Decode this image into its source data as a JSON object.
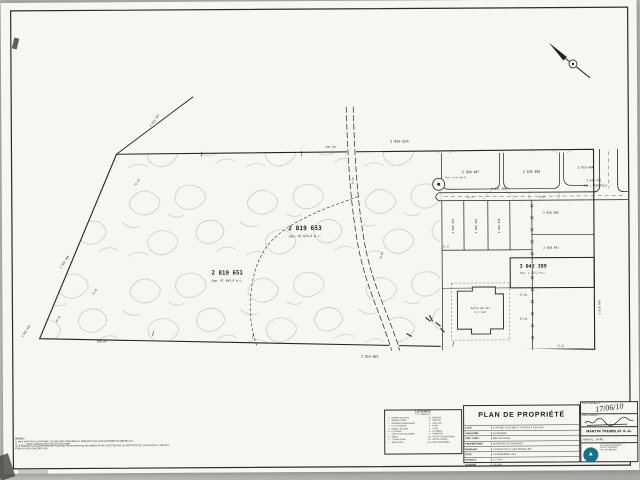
{
  "plan": {
    "labels": [
      {
        "t": "2 819 653",
        "x": 303,
        "y": 229,
        "s": 6.2,
        "b": 1
      },
      {
        "t": "Sup: 45 874,6 m.c.",
        "x": 303,
        "y": 236,
        "s": 3.0
      },
      {
        "t": "2 819 651",
        "x": 225,
        "y": 273,
        "s": 5.8,
        "b": 1
      },
      {
        "t": "Sup: 97 403,9 m.c.",
        "x": 225,
        "y": 280,
        "s": 2.9
      },
      {
        "t": "3 042 389",
        "x": 531,
        "y": 268,
        "s": 5.0,
        "b": 1
      },
      {
        "t": "Sup: 1 277,2 m.c.",
        "x": 531,
        "y": 274,
        "s": 2.6
      },
      {
        "t": "2 819 654",
        "x": 398,
        "y": 142,
        "s": 3.4
      },
      {
        "t": "237,34",
        "x": 329,
        "y": 147,
        "s": 2.8
      },
      {
        "t": "2 820 407",
        "x": 469,
        "y": 173,
        "s": 3.2
      },
      {
        "t": "2 820 408",
        "x": 530,
        "y": 173,
        "s": 3.2
      },
      {
        "t": "2 819 604",
        "x": 584,
        "y": 169,
        "s": 2.9
      },
      {
        "t": "3 040 762",
        "x": 592,
        "y": 182,
        "s": 2.7
      },
      {
        "t": "RUE L'HIRONDELLE",
        "x": 594,
        "y": 187,
        "s": 2.4
      },
      {
        "t": "3 042 386",
        "x": 497,
        "y": 190,
        "s": 2.9
      },
      {
        "t": "2 820 463",
        "x": 452,
        "y": 226,
        "s": 2.7,
        "r": -90
      },
      {
        "t": "2 820 462",
        "x": 475,
        "y": 226,
        "s": 2.7,
        "r": -90
      },
      {
        "t": "2 820 460",
        "x": 498,
        "y": 226,
        "s": 2.7,
        "r": -90
      },
      {
        "t": "2 820 485",
        "x": 549,
        "y": 214,
        "s": 2.9
      },
      {
        "t": "2 820 461",
        "x": 549,
        "y": 249,
        "s": 2.9
      },
      {
        "t": "57,91",
        "x": 521,
        "y": 296,
        "s": 2.5
      },
      {
        "t": "57,91",
        "x": 521,
        "y": 320,
        "s": 2.5
      },
      {
        "t": "2 819 602",
        "x": 367,
        "y": 357,
        "s": 3.2
      },
      {
        "t": "100,86",
        "x": 99,
        "y": 340,
        "s": 2.7
      },
      {
        "t": "2 819 497",
        "x": 154,
        "y": 119,
        "s": 2.7,
        "r": -54
      },
      {
        "t": "72,43",
        "x": 136,
        "y": 181,
        "s": 2.5,
        "r": -54
      },
      {
        "t": "2 819 598",
        "x": 63,
        "y": 260,
        "s": 2.7,
        "r": -56
      },
      {
        "t": "74,16",
        "x": 93,
        "y": 290,
        "s": 2.4,
        "r": -56
      },
      {
        "t": "29,42",
        "x": 56,
        "y": 317,
        "s": 2.4,
        "r": -56
      },
      {
        "t": "2 819 596",
        "x": 24,
        "y": 329,
        "s": 2.6,
        "r": -56
      },
      {
        "t": "2 819 607",
        "x": 598,
        "y": 308,
        "s": 2.7,
        "r": -90
      },
      {
        "t": "Salle de tir",
        "x": 478,
        "y": 309,
        "s": 2.7
      },
      {
        "t": "à l'arc",
        "x": 478,
        "y": 313,
        "s": 2.7
      },
      {
        "t": "Pos. d'un puits",
        "x": 444,
        "y": 178,
        "s": 2.3,
        "a": "s"
      },
      {
        "t": "15,24",
        "x": 468,
        "y": 198,
        "s": 2.1
      },
      {
        "t": "30,48",
        "x": 540,
        "y": 198,
        "s": 2.1
      },
      {
        "t": "37,21",
        "x": 558,
        "y": 347,
        "s": 2.3
      },
      {
        "t": "31,35",
        "x": 444,
        "y": 247,
        "s": 2.1
      },
      {
        "t": "35,05",
        "x": 380,
        "y": 255,
        "s": 2.3,
        "r": -80
      },
      {
        "t": "19,20",
        "x": 352,
        "y": 180,
        "s": 2.3,
        "r": -85
      }
    ]
  },
  "legend": {
    "title": "LÉGENDE",
    "subtitle": "( ET SYMBOLES )",
    "left": [
      {
        "sym": "●",
        "label": "BORNE TROUVÉE"
      },
      {
        "sym": "○",
        "label": "BORNE POSÉE"
      },
      {
        "sym": "▪",
        "label": "REPÈRE D'ARPENTAGE"
      },
      {
        "sym": "□",
        "label": "CLOU TROUVÉ"
      },
      {
        "sym": "△",
        "label": "PIQUET DE BOIS"
      },
      {
        "sym": "—×—",
        "label": "CLÔTURE"
      },
      {
        "sym": "– – –",
        "label": "LIMITE NON JALONNÉE"
      },
      {
        "sym": "⊙",
        "label": "PUITS"
      },
      {
        "sym": "≈",
        "label": "COURS D'EAU"
      },
      {
        "sym": "╌╌",
        "label": "SERVITUDE"
      }
    ],
    "right": [
      {
        "sym": "M",
        "label": "MESURE"
      },
      {
        "sym": "R",
        "label": "RÉNOVÉ"
      },
      {
        "sym": "C",
        "label": "CALCULÉ"
      },
      {
        "sym": "P",
        "label": "PLAN"
      },
      {
        "sym": "T",
        "label": "TITRE"
      },
      {
        "sym": "A",
        "label": "ATTRIBUÉ"
      },
      {
        "sym": "⌀",
        "label": "DIAMÈTRE"
      },
      {
        "sym": "S.I.",
        "label": "SYST. INTERNATIONAL"
      },
      {
        "sym": "m.c.",
        "label": "MÈTRE CARRÉ"
      },
      {
        "sym": "N.D.",
        "label": "NON DISPONIBLE"
      }
    ]
  },
  "titleblock": {
    "title": "PLAN DE PROPRIÉTÉ",
    "rows": [
      {
        "label": "LOTS",
        "value": "3 042 386, 3 042 389 ET 2 819 651 À 2 819 653"
      },
      {
        "label": "CADASTRE",
        "value": "DU QUÉBEC"
      },
      {
        "label": "CIRC. FONC.",
        "value": "BELLECHASSE"
      },
      {
        "label": "PROPRIÉTAIRE",
        "value": "MUNICIPALITÉ DE MAGOG"
      },
      {
        "label": "MANDANT",
        "value": "CLUB DE TIR À L'ARC MAGOG INC."
      },
      {
        "label": "DATE",
        "value": "19 DÉCEMBRE 2013"
      },
      {
        "label": "ÉCHELLE",
        "value": "1 : 2 000"
      },
      {
        "label": "DOSSIER",
        "value": "13-1426"
      }
    ]
  },
  "certbox": {
    "date_label": "COPIE CONFORME LE :",
    "date_value": "17/06/10",
    "sign_label": "SIGNÉ À MAGOG LE :",
    "name": "MARTIN TREMBLAY A.-G.",
    "minute_label": "MINUTE :",
    "minute_value": "14 362",
    "stamp_glyph": "▲",
    "firm_script": "Tremblay a.-g. inc.",
    "firm_lines": [
      "ARPENTEURS-GÉOMÈTRES",
      "940, RUE DES ÉRABLES",
      "MAGOG (QUÉBEC)",
      "TÉL.: 819 843-0000"
    ]
  },
  "notes": {
    "heading": "NOTES :",
    "lines": [
      "1) SAUF INDICATION CONTRAIRE, LES MESURES INDIQUÉES AU PRÉSENT PLAN SONT EXPRIMÉES EN MÈTRES (SI).",
      "2) ——— : LIMITE LATÉRALE DE LOTS NON JALONNÉE.",
      "3) LE PRÉSENT PLAN A ÉTÉ PRÉPARÉ POUR FINS DE DESCRIPTION SEULEMENT ET NE CONSTITUE PAS UN CERTIFICAT DE LOCALISATION; IL NE PEUT ÊTRE UTILISÉ À D'AUTRES FINS."
    ]
  }
}
